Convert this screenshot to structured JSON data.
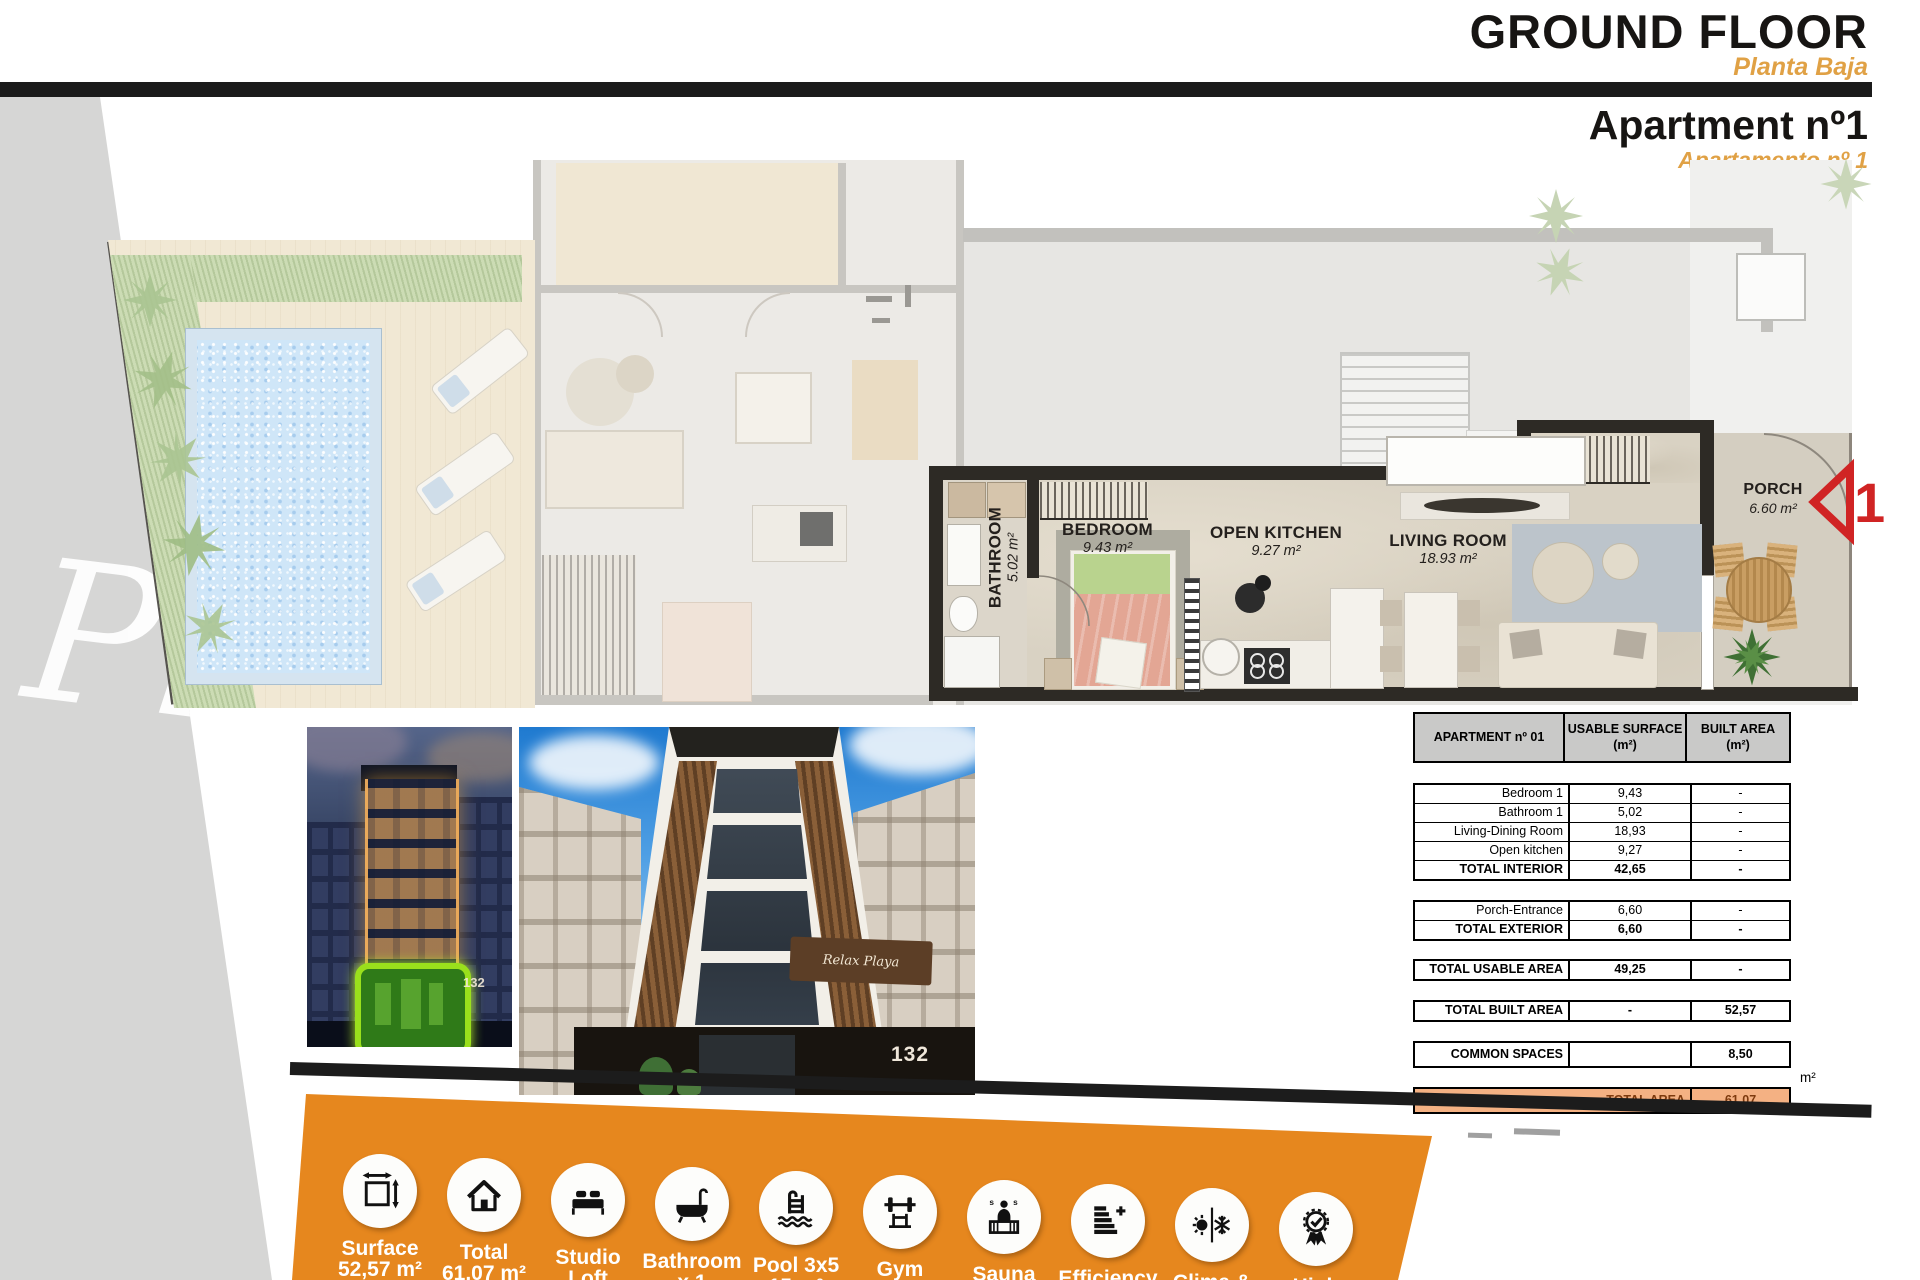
{
  "header": {
    "title": "GROUND FLOOR",
    "subtitle": "Planta Baja",
    "apartment_title": "Apartment nº1",
    "apartment_subtitle": "Apartamento nº 1"
  },
  "floor_plan": {
    "watermark": "Pl",
    "unit_marker": "1",
    "rooms": {
      "bathroom": {
        "name": "BATHROOM",
        "area": "5.02 m²"
      },
      "bedroom": {
        "name": "BEDROOM",
        "area": "9.43 m²"
      },
      "open_kitchen": {
        "name": "OPEN KITCHEN",
        "area": "9.27 m²"
      },
      "living_room": {
        "name": "LIVING ROOM",
        "area": "18.93 m²"
      },
      "porch": {
        "name": "PORCH",
        "area": "6.60 m²"
      }
    }
  },
  "photos": {
    "photo1": {
      "house_number": "132"
    },
    "photo2": {
      "house_number": "132",
      "sign": "Relax Playa"
    }
  },
  "area_table": {
    "header": {
      "col1": "APARTMENT nº 01",
      "col2_line1": "USABLE SURFACE",
      "col2_line2": "(m²)",
      "col3_line1": "BUILT AREA",
      "col3_line2": "(m²)"
    },
    "interior_rows": [
      {
        "label": "Bedroom 1",
        "usable": "9,43",
        "built": "-"
      },
      {
        "label": "Bathroom 1",
        "usable": "5,02",
        "built": "-"
      },
      {
        "label": "Living-Dining Room",
        "usable": "18,93",
        "built": "-"
      },
      {
        "label": "Open kitchen",
        "usable": "9,27",
        "built": "-"
      },
      {
        "label": "TOTAL INTERIOR",
        "usable": "42,65",
        "built": "-"
      }
    ],
    "exterior_rows": [
      {
        "label": "Porch-Entrance",
        "usable": "6,60",
        "built": "-"
      },
      {
        "label": "TOTAL EXTERIOR",
        "usable": "6,60",
        "built": "-"
      }
    ],
    "usable_row": {
      "label": "TOTAL USABLE AREA",
      "usable": "49,25",
      "built": "-"
    },
    "built_row": {
      "label": "TOTAL BUILT AREA",
      "usable": "-",
      "built": "52,57"
    },
    "common_row": {
      "label": "COMMON SPACES",
      "usable": "",
      "built": "8,50"
    },
    "total_row": {
      "label": "TOTAL AREA",
      "value": "61,07"
    },
    "total_unit": "m²"
  },
  "features_bar": {
    "items": [
      {
        "line1": "Surface",
        "line2": "52,57 m²",
        "icon": "dimensions-icon"
      },
      {
        "line1": "Total",
        "line2": "61,07 m²",
        "icon": "house-icon"
      },
      {
        "line1": "Studio",
        "line2": "Loft",
        "icon": "bed-icon"
      },
      {
        "line1": "Bathroom",
        "line2": "x 1",
        "icon": "bathtub-icon"
      },
      {
        "line1": "Pool 3x5",
        "line2": "15 m²",
        "icon": "pool-ladder-icon"
      },
      {
        "line1": "Gym",
        "line2": "10 m²",
        "icon": "gym-icon"
      },
      {
        "line1": "Sauna",
        "line2": "6 pers",
        "icon": "sauna-icon"
      },
      {
        "line1": "Efficiency",
        "line2": "A+",
        "icon": "efficiency-icon"
      },
      {
        "line1": "Clima &",
        "line2": "Heating",
        "icon": "climate-icon"
      },
      {
        "line1": "High",
        "line2": "quality",
        "icon": "award-icon"
      }
    ]
  },
  "colors": {
    "accent_orange": "#E0A145",
    "bar_orange": "#E6871E",
    "total_row_bg": "#F4B183",
    "marker_red": "#D02424",
    "highlight_green": "#9AE01C"
  }
}
